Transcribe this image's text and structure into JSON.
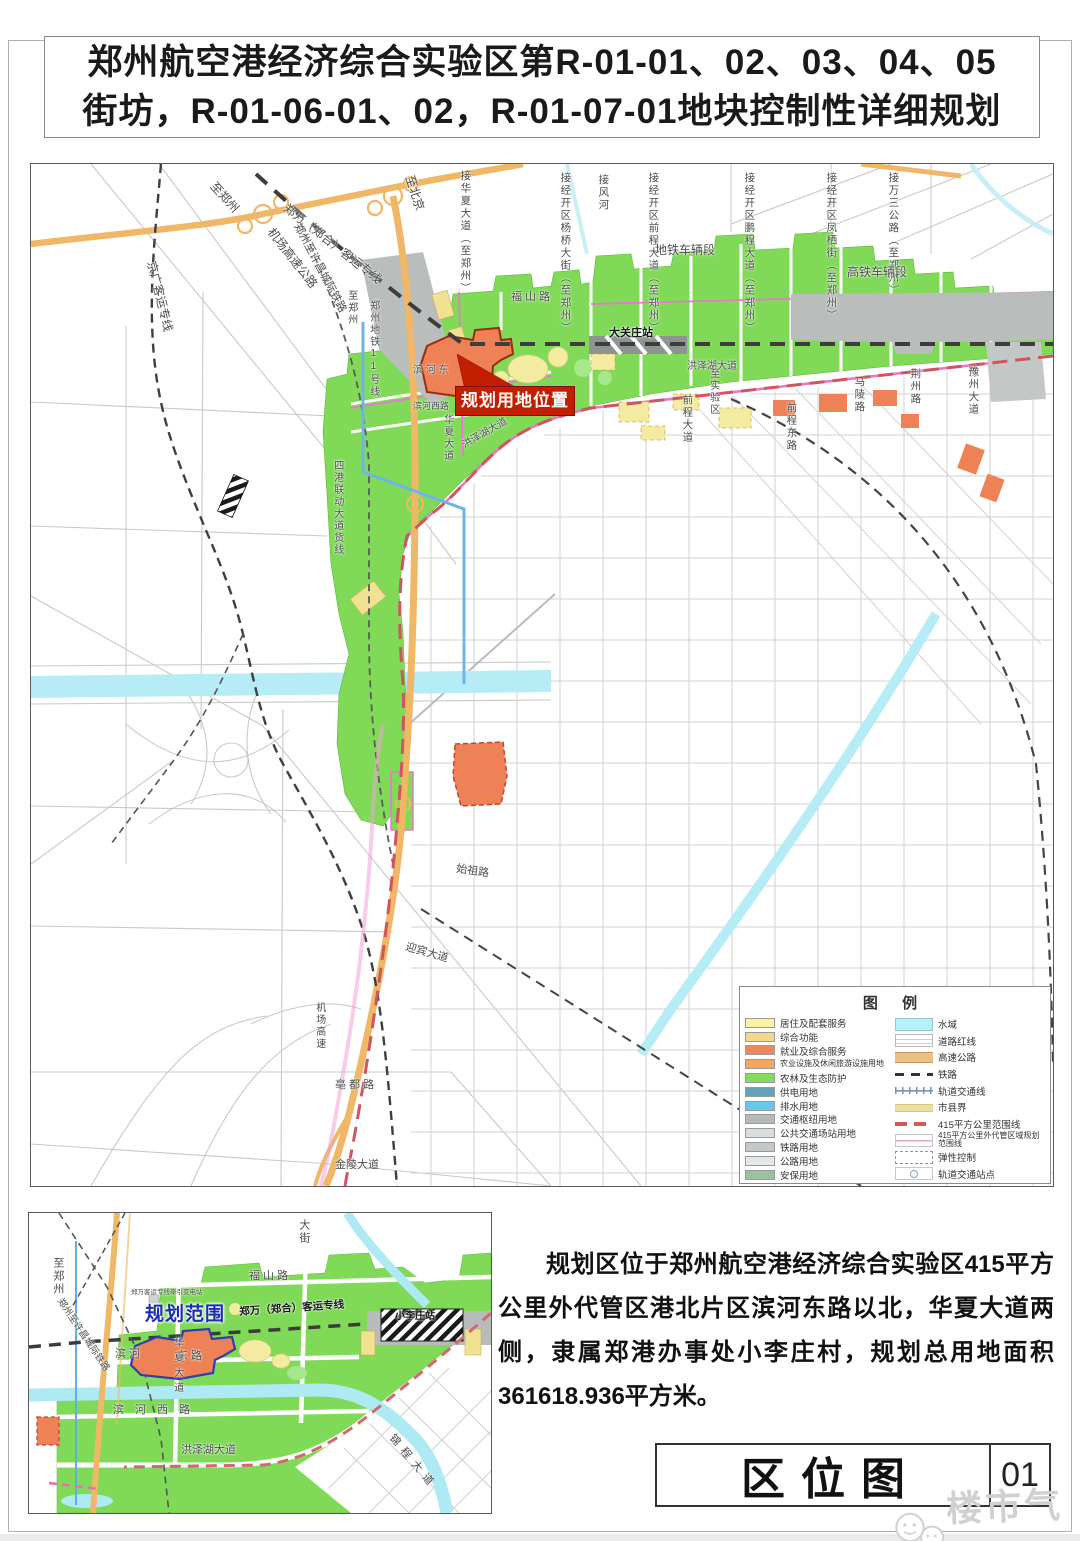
{
  "title": {
    "line1": "郑州航空港经济综合实验区第R-01-01、02、03、04、05",
    "line2": "街坊，R-01-06-01、02，R-01-07-01地块控制性详细规划"
  },
  "main_map": {
    "planning_location_label": "规划用地位置",
    "legend": {
      "title": "图 例",
      "left_items": [
        {
          "label": "居住及配套服务",
          "color": "#f9f3a2"
        },
        {
          "label": "综合功能",
          "color": "#f6d789"
        },
        {
          "label": "就业及综合服务",
          "color": "#ee8660"
        },
        {
          "label": "农业设施及休闲旅游设施用地",
          "color": "#f3a75e",
          "small": true
        },
        {
          "label": "农林及生态防护",
          "color": "#83dc5e"
        },
        {
          "label": "供电用地",
          "color": "#66a3ba"
        },
        {
          "label": "排水用地",
          "color": "#66c8ee"
        },
        {
          "label": "交通枢纽用地",
          "color": "#b6baba"
        },
        {
          "label": "公共交通场站用地",
          "color": "#d9dddc"
        },
        {
          "label": "铁路用地",
          "color": "#c4c8c7"
        },
        {
          "label": "公路用地",
          "color": "#e4e8e7"
        },
        {
          "label": "安保用地",
          "color": "#9dc29b"
        }
      ],
      "right_items": [
        {
          "label": "水域",
          "kind": "water"
        },
        {
          "label": "道路红线",
          "kind": "redline"
        },
        {
          "label": "高速公路",
          "kind": "hwy"
        },
        {
          "label": "铁路",
          "kind": "rail"
        },
        {
          "label": "轨道交通线",
          "kind": "metro"
        },
        {
          "label": "市县界",
          "kind": "county"
        },
        {
          "label": "415平方公里范围线",
          "kind": "415"
        },
        {
          "label": "415平方公里外代管区域规划范围线",
          "kind": "415outer",
          "small": true
        },
        {
          "label": "弹性控制",
          "kind": "elastic"
        },
        {
          "label": "轨道交通站点",
          "kind": "station"
        }
      ]
    },
    "labels": [
      {
        "t": "至郑州",
        "x": 186,
        "y": 16,
        "r": 48,
        "s": 12
      },
      {
        "t": "至北京",
        "x": 384,
        "y": 10,
        "r": 72,
        "s": 12
      },
      {
        "t": "接华夏大道（至郑州）",
        "x": 428,
        "y": 6,
        "v": 1,
        "s": 10.5
      },
      {
        "t": "接风河",
        "x": 566,
        "y": 10,
        "v": 1,
        "s": 10.5
      },
      {
        "t": "接经开区杨桥大街（至郑州）",
        "x": 528,
        "y": 8,
        "v": 1,
        "s": 10.5
      },
      {
        "t": "接经开区前程大道（至郑州）",
        "x": 616,
        "y": 8,
        "v": 1,
        "s": 10.5
      },
      {
        "t": "接经开区鹏程大道（至郑州）",
        "x": 712,
        "y": 8,
        "v": 1,
        "s": 10.5
      },
      {
        "t": "接经开区凤栖街（至郑州）",
        "x": 794,
        "y": 8,
        "v": 1,
        "s": 10.5
      },
      {
        "t": "接万三公路（至郑州）",
        "x": 856,
        "y": 8,
        "v": 1,
        "s": 10.5
      },
      {
        "t": "京广客运专线",
        "x": 126,
        "y": 96,
        "r": 76,
        "s": 12
      },
      {
        "t": "机场高速公路",
        "x": 244,
        "y": 62,
        "r": 52,
        "s": 12
      },
      {
        "t": "郑万（郑合）客运专线",
        "x": 258,
        "y": 38,
        "r": 38,
        "s": 12
      },
      {
        "t": "郑州至许昌城际铁路",
        "x": 270,
        "y": 58,
        "r": 62,
        "s": 11
      },
      {
        "t": "至郑州",
        "x": 314,
        "y": 126,
        "v": 1,
        "s": 10
      },
      {
        "t": "郑州地铁11号线",
        "x": 336,
        "y": 136,
        "v": 1,
        "s": 10
      },
      {
        "t": "福 山 路",
        "x": 480,
        "y": 128,
        "s": 11
      },
      {
        "t": "地铁车辆段",
        "x": 624,
        "y": 80,
        "s": 12
      },
      {
        "t": "高铁车辆段",
        "x": 816,
        "y": 102,
        "s": 12
      },
      {
        "t": "大关庄站",
        "x": 578,
        "y": 164,
        "s": 11,
        "cls": "dark"
      },
      {
        "t": "滨 河 东",
        "x": 382,
        "y": 202,
        "s": 10
      },
      {
        "t": "滨河西路",
        "x": 382,
        "y": 238,
        "s": 9
      },
      {
        "t": "华夏大道",
        "x": 410,
        "y": 250,
        "v": 1,
        "s": 10
      },
      {
        "t": "洪泽湖大道",
        "x": 430,
        "y": 278,
        "r": -30,
        "s": 10
      },
      {
        "t": "洪泽湖大道",
        "x": 656,
        "y": 198,
        "s": 10
      },
      {
        "t": "至实验区",
        "x": 676,
        "y": 204,
        "v": 1,
        "s": 10
      },
      {
        "t": "前程大道",
        "x": 650,
        "y": 230,
        "v": 1,
        "s": 10.5
      },
      {
        "t": "前程东路",
        "x": 754,
        "y": 238,
        "v": 1,
        "s": 10.5
      },
      {
        "t": "马陵路",
        "x": 822,
        "y": 212,
        "v": 1,
        "s": 10.5
      },
      {
        "t": "荆州路",
        "x": 878,
        "y": 204,
        "v": 1,
        "s": 10.5
      },
      {
        "t": "豫州大道",
        "x": 936,
        "y": 202,
        "v": 1,
        "s": 10.5
      },
      {
        "t": "四港联动大道货线",
        "x": 300,
        "y": 296,
        "v": 1,
        "s": 10
      },
      {
        "t": "机场高速",
        "x": 282,
        "y": 838,
        "v": 1,
        "s": 10
      },
      {
        "t": "迎宾大道",
        "x": 376,
        "y": 778,
        "r": 16,
        "s": 11
      },
      {
        "t": "始祖路",
        "x": 426,
        "y": 700,
        "r": 8,
        "s": 11
      },
      {
        "t": "亳 都 路",
        "x": 304,
        "y": 916,
        "s": 11
      },
      {
        "t": "金陵大道",
        "x": 304,
        "y": 996,
        "s": 11
      }
    ]
  },
  "inset_map": {
    "labels": [
      {
        "t": "大街",
        "x": 268,
        "y": 6,
        "v": 1,
        "s": 11
      },
      {
        "t": "福 山 路",
        "x": 220,
        "y": 58,
        "s": 11
      },
      {
        "t": "至郑州",
        "x": 22,
        "y": 44,
        "v": 1,
        "s": 11
      },
      {
        "t": "郑州至许昌城际铁路",
        "x": 34,
        "y": 84,
        "r": 56,
        "s": 9.5
      },
      {
        "t": "郑万客运专线牵引变电站",
        "x": 102,
        "y": 76,
        "s": 6.5
      },
      {
        "t": "规划范围",
        "x": 116,
        "y": 92,
        "s": 19,
        "cls": "blue"
      },
      {
        "t": "郑万（郑合）客运专线",
        "x": 210,
        "y": 94,
        "r": -4,
        "s": 10.5,
        "cls": "dark"
      },
      {
        "t": "小李庄站",
        "x": 366,
        "y": 99,
        "s": 10,
        "cls": "dark"
      },
      {
        "t": "滨 河",
        "x": 86,
        "y": 136,
        "s": 11
      },
      {
        "t": "东 路",
        "x": 148,
        "y": 138,
        "s": 11
      },
      {
        "t": "华夏大道",
        "x": 142,
        "y": 124,
        "v": 1,
        "s": 10,
        "ls": 5
      },
      {
        "t": "滨 河 西 路",
        "x": 84,
        "y": 192,
        "s": 11,
        "ls": 4
      },
      {
        "t": "洪泽湖大道",
        "x": 152,
        "y": 232,
        "s": 11
      },
      {
        "t": "锦程大道",
        "x": 366,
        "y": 220,
        "r": 50,
        "s": 11,
        "ls": 6
      }
    ]
  },
  "description": "规划区位于郑州航空港经济综合实验区415平方公里外代管区港北片区滨河东路以北，华夏大道两侧，隶属郑港办事处小李庄村，规划总用地面积361618.936平方米。",
  "titleblock": {
    "name": "区位图",
    "number": "01"
  },
  "watermark": "楼市气象"
}
